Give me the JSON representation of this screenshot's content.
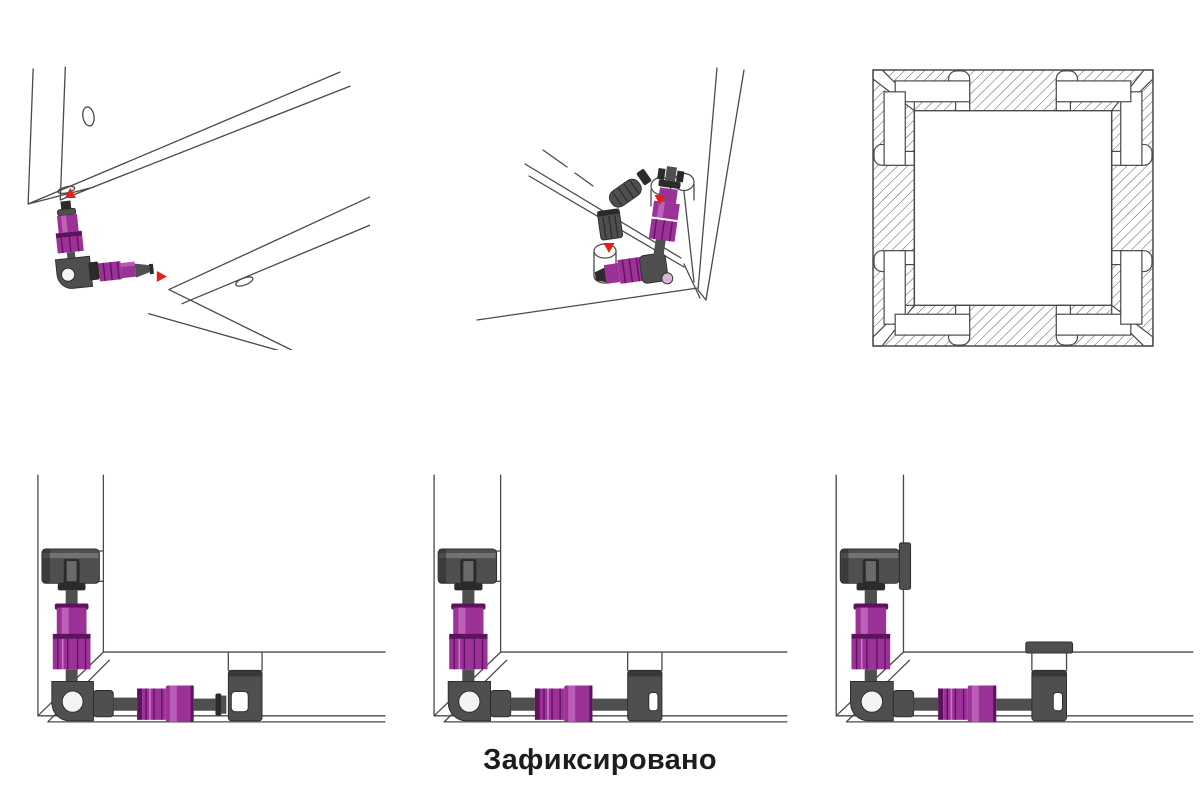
{
  "caption": {
    "text": "Зафиксировано"
  },
  "colors": {
    "bg": "#ffffff",
    "ink": "#1c1c1c",
    "line": "#4a4a4a",
    "accent": "#9c3198",
    "accent_light": "#c977c6",
    "accent_dark": "#5e115c",
    "accent_pale": "#d9b7d6",
    "metal": "#4f4f4f",
    "metal_light": "#8f8f8f",
    "metal_dark": "#2b2b2b",
    "arrow": "#e41f17",
    "cam": "#f4f4f4"
  }
}
